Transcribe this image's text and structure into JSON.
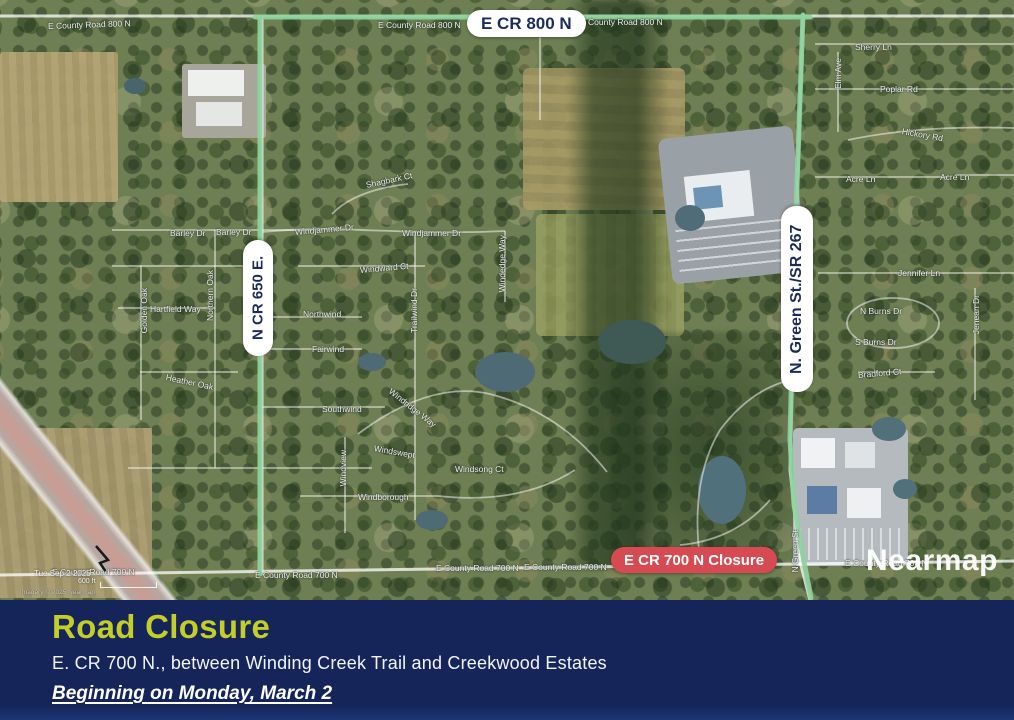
{
  "map": {
    "route_labels": {
      "top": "E CR 800 N",
      "left": "N CR 650 E.",
      "right": "N. Green St./SR 267"
    },
    "closure_label": "E CR 700 N Closure",
    "watermark": "Nearmap",
    "capture_date": "Tue Sep 2 2025",
    "scale_text": "600 ft",
    "attribution": "Imagery © 2025 Nearmap",
    "street_labels": [
      {
        "t": "E County Road 800 N",
        "x": 48,
        "y": 21,
        "r": -2
      },
      {
        "t": "E County Road 800 N",
        "x": 378,
        "y": 20
      },
      {
        "t": "E County Road 800 N",
        "x": 580,
        "y": 17
      },
      {
        "t": "Sherry Ln",
        "x": 855,
        "y": 42
      },
      {
        "t": "Elm Ave",
        "x": 833,
        "y": 58,
        "v": true
      },
      {
        "t": "Poplar Rd",
        "x": 880,
        "y": 84
      },
      {
        "t": "Hickory Rd",
        "x": 902,
        "y": 126,
        "r": 10
      },
      {
        "t": "Acre Ln",
        "x": 846,
        "y": 174
      },
      {
        "t": "Acre Ln",
        "x": 940,
        "y": 172
      },
      {
        "t": "Jennifer Ln",
        "x": 898,
        "y": 268
      },
      {
        "t": "N Burns Dr",
        "x": 860,
        "y": 306
      },
      {
        "t": "S Burns Dr",
        "x": 855,
        "y": 337
      },
      {
        "t": "Jenean Dr",
        "x": 971,
        "y": 295,
        "v": true
      },
      {
        "t": "Bradford Ct",
        "x": 858,
        "y": 370,
        "r": -5
      },
      {
        "t": "Shagbark Ct",
        "x": 366,
        "y": 180,
        "r": -12
      },
      {
        "t": "Windjammer Dr",
        "x": 295,
        "y": 227,
        "r": -5
      },
      {
        "t": "Windjammer Dr",
        "x": 402,
        "y": 228
      },
      {
        "t": "Windward Ct",
        "x": 360,
        "y": 265,
        "r": -5
      },
      {
        "t": "Trailwind Dr",
        "x": 409,
        "y": 288,
        "v": true
      },
      {
        "t": "Windedge Way",
        "x": 497,
        "y": 235,
        "v": true
      },
      {
        "t": "Northwind",
        "x": 303,
        "y": 309
      },
      {
        "t": "Fairwind",
        "x": 312,
        "y": 344
      },
      {
        "t": "Southwind",
        "x": 322,
        "y": 404
      },
      {
        "t": "Windridge Way",
        "x": 390,
        "y": 385,
        "r": 38
      },
      {
        "t": "Windswept",
        "x": 374,
        "y": 443,
        "r": 10
      },
      {
        "t": "Windview",
        "x": 338,
        "y": 450,
        "v": true
      },
      {
        "t": "Windsong Ct",
        "x": 455,
        "y": 464
      },
      {
        "t": "Windborough",
        "x": 358,
        "y": 492
      },
      {
        "t": "Barley Dr",
        "x": 170,
        "y": 228
      },
      {
        "t": "Barley Dr",
        "x": 216,
        "y": 227
      },
      {
        "t": "Hartfield Way",
        "x": 150,
        "y": 304
      },
      {
        "t": "Northern Oak",
        "x": 205,
        "y": 270,
        "v": true
      },
      {
        "t": "Golden Oak",
        "x": 139,
        "y": 288,
        "v": true
      },
      {
        "t": "Heather Oak",
        "x": 166,
        "y": 372,
        "r": 12
      },
      {
        "t": "E County Road 700 N",
        "x": 52,
        "y": 567
      },
      {
        "t": "E County Road 700 N",
        "x": 255,
        "y": 570
      },
      {
        "t": "E County Road 700 N",
        "x": 436,
        "y": 563
      },
      {
        "t": "E County Road 700 N",
        "x": 524,
        "y": 562
      },
      {
        "t": "E County Road 700 N",
        "x": 845,
        "y": 558
      },
      {
        "t": "N Green St",
        "x": 790,
        "y": 530,
        "v": true
      }
    ],
    "colors": {
      "route_green": "#8ED29E",
      "closure_bg": "#D84A52",
      "pill_text": "#1B2C5C"
    }
  },
  "banner": {
    "title": "Road Closure",
    "subtitle": "E. CR 700 N., between Winding Creek Trail and Creekwood Estates",
    "date_line": "Beginning on Monday, March 2",
    "colors": {
      "bg": "#15255A",
      "title": "#C3CE29",
      "text": "#FFFFFF"
    }
  }
}
